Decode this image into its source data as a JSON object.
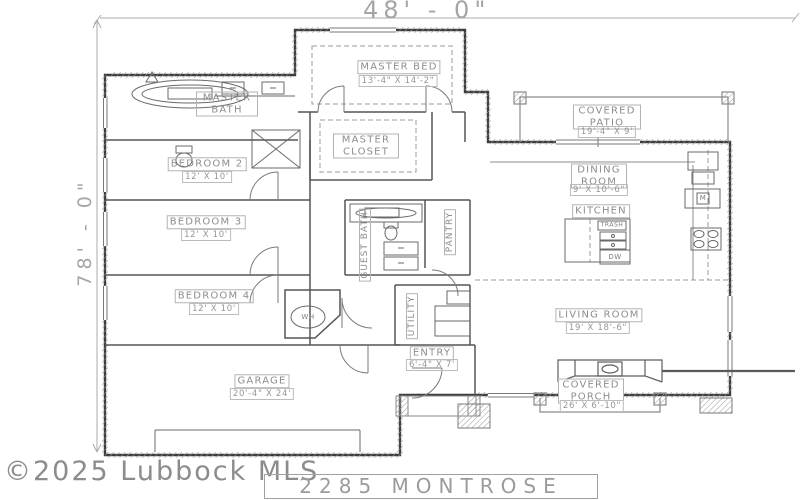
{
  "meta": {
    "title": "2285 MONTROSE",
    "watermark": "©2025 Lubbock MLS",
    "width_dim": "48' - 0\"",
    "height_dim": "78' - 0\""
  },
  "rooms": {
    "master_bed": {
      "name": "MASTER BED",
      "dims": "13'-4\" X 14'-2\""
    },
    "master_bath": {
      "name": "MASTER BATH"
    },
    "master_closet": {
      "name": "MASTER CLOSET"
    },
    "bedroom2": {
      "name": "BEDROOM 2",
      "dims": "12' X 10'"
    },
    "bedroom3": {
      "name": "BEDROOM 3",
      "dims": "12' X 10'"
    },
    "bedroom4": {
      "name": "BEDROOM 4",
      "dims": "12' X 10'"
    },
    "guest_bath": {
      "name": "GUEST BATH"
    },
    "pantry": {
      "name": "PANTRY"
    },
    "utility": {
      "name": "UTILITY"
    },
    "covered_patio": {
      "name": "COVERED PATIO",
      "dims": "19'-4\" X 9'"
    },
    "dining": {
      "name": "DINING ROOM",
      "dims": "9' X 10'-6\""
    },
    "kitchen": {
      "name": "KITCHEN"
    },
    "living": {
      "name": "LIVING ROOM",
      "dims": "19' X 18'-6\""
    },
    "entry": {
      "name": "ENTRY",
      "dims": "6'-4\" X 7'"
    },
    "covered_porch": {
      "name": "COVERED PORCH",
      "dims": "26' X 6'-10\""
    },
    "garage": {
      "name": "GARAGE",
      "dims": "20'-4\" X 24'"
    }
  },
  "fixtures": {
    "water_heater": "WH",
    "dishwasher": "DW",
    "trash": "TRASH",
    "microwave": "M"
  },
  "colors": {
    "line": "#3d3d3d",
    "label": "#8d8d8d",
    "watermark": "#8c8c8c"
  }
}
